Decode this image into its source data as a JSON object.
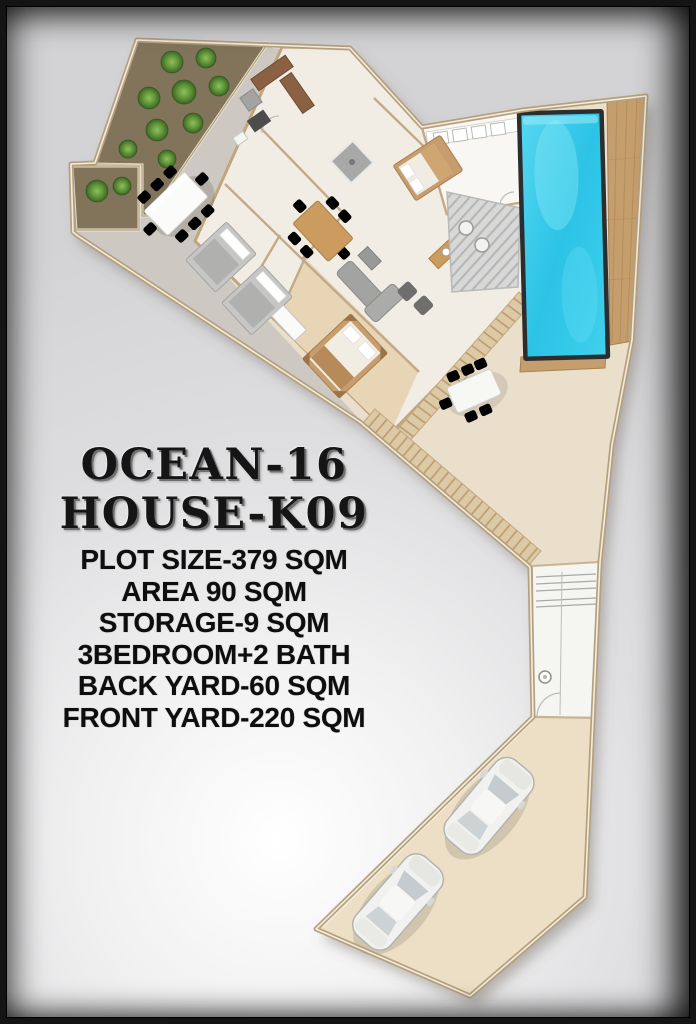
{
  "title": {
    "line1": "OCEAN-16",
    "line2": "HOUSE-K09"
  },
  "specs": {
    "lines": [
      "PLOT SIZE-379 SQM",
      "AREA 90 SQM",
      "STORAGE-9 SQM",
      "3BEDROOM+2 BATH",
      "BACK YARD-60 SQM",
      "FRONT YARD-220 SQM"
    ]
  },
  "colors": {
    "background_gray": "#d3d3d5",
    "frame_black": "#141414",
    "plot_floor": "#e9dfca",
    "terrace_concrete": "#cdc9c2",
    "garden_soil": "#81745a",
    "bush_green": "#5d9038",
    "house_floor": "#f2ede4",
    "bedroom_floor": "#e7d5b6",
    "kitchen_floor": "#f8f7f3",
    "wall_wood": "#b5a07e",
    "deck_wood": "#c59e6e",
    "pool_water": "#2cc3e6",
    "pool_rim": "#2c2d2e",
    "driveway": "#ecdfc5",
    "car_body": "#f1f1ef",
    "text_color": "#121212"
  },
  "plan_features": [
    "front-garden",
    "side-garden",
    "backyard-terrace",
    "terrace-dining-set",
    "house-interior",
    "kitchen",
    "bathroom",
    "shower",
    "bedroom-1",
    "bedroom-2",
    "master-bedroom",
    "living-room",
    "dining-set",
    "entry-deck",
    "wood-walkway",
    "swimming-pool",
    "pool-deck",
    "patio-dining-set",
    "storage-corridor",
    "driveway",
    "car-1",
    "car-2"
  ]
}
